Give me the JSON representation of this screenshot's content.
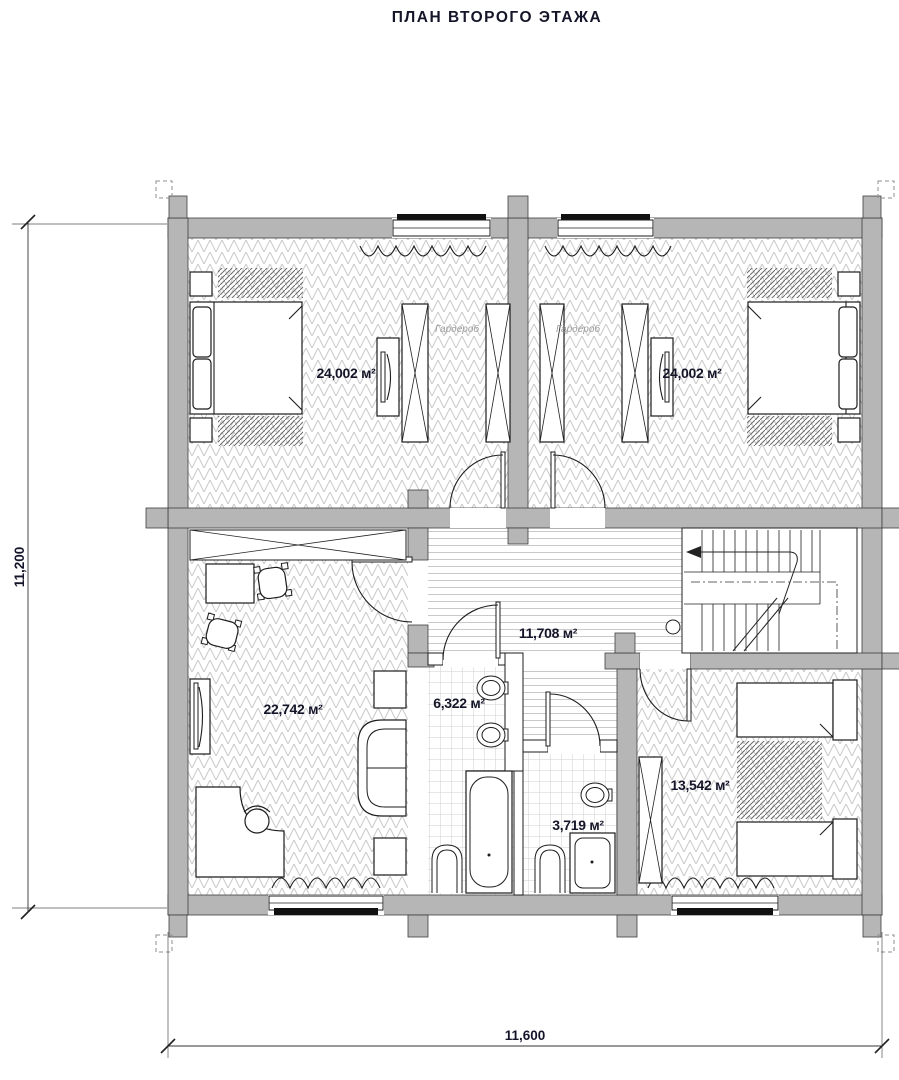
{
  "title": "ПЛАН ВТОРОГО ЭТАЖА",
  "dimensions": {
    "left": "11,200",
    "bottom": "11,600"
  },
  "rooms": {
    "bedroom_left": {
      "area": "24,002 м²",
      "wardrobe_label": "Гардероб"
    },
    "bedroom_right": {
      "area": "24,002 м²",
      "wardrobe_label": "Гардероб"
    },
    "hall": {
      "area": "11,708 м²"
    },
    "study": {
      "area": "22,742 м²"
    },
    "bathroom": {
      "area": "6,322 м²"
    },
    "shower_room": {
      "area": "3,719 м²"
    },
    "bedroom_small": {
      "area": "13,542 м²"
    }
  }
}
